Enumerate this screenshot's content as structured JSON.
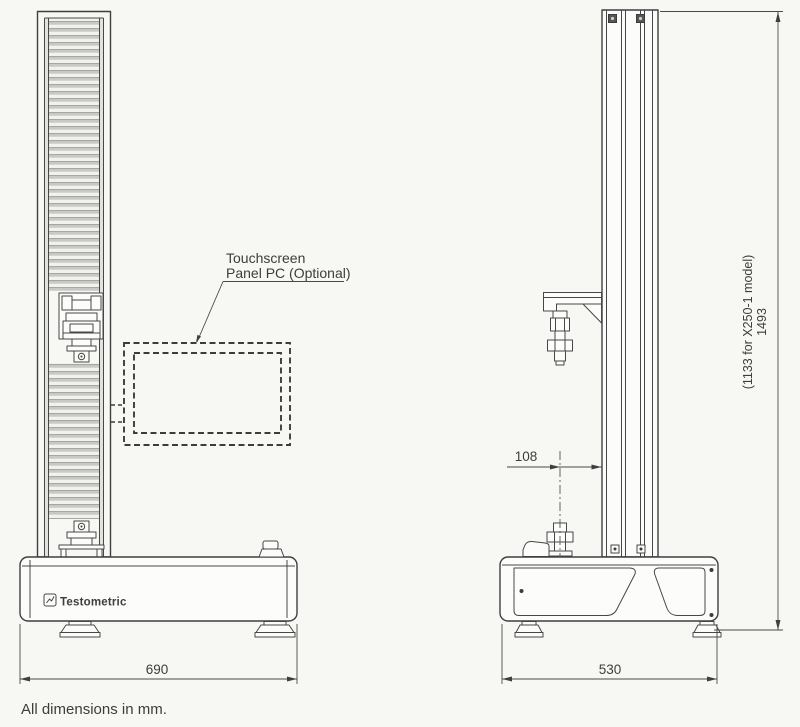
{
  "page": {
    "background": "#f7f7f4",
    "line_color": "#474747"
  },
  "labels": {
    "touchscreen": {
      "line1": "Touchscreen",
      "line2": "Panel PC (Optional)"
    }
  },
  "dimensions": {
    "base_width_front": {
      "value": "690"
    },
    "base_depth_side": {
      "value": "530"
    },
    "grip_offset": {
      "value": "108"
    },
    "machine_height": {
      "value": "1493",
      "alt_model_note": "(1133 for X250-1 model)"
    }
  },
  "branding": {
    "logo_text": "Testometric"
  },
  "icons": {
    "logo": "testometric-logo-icon"
  },
  "footer": {
    "note": "All dimensions in mm."
  }
}
